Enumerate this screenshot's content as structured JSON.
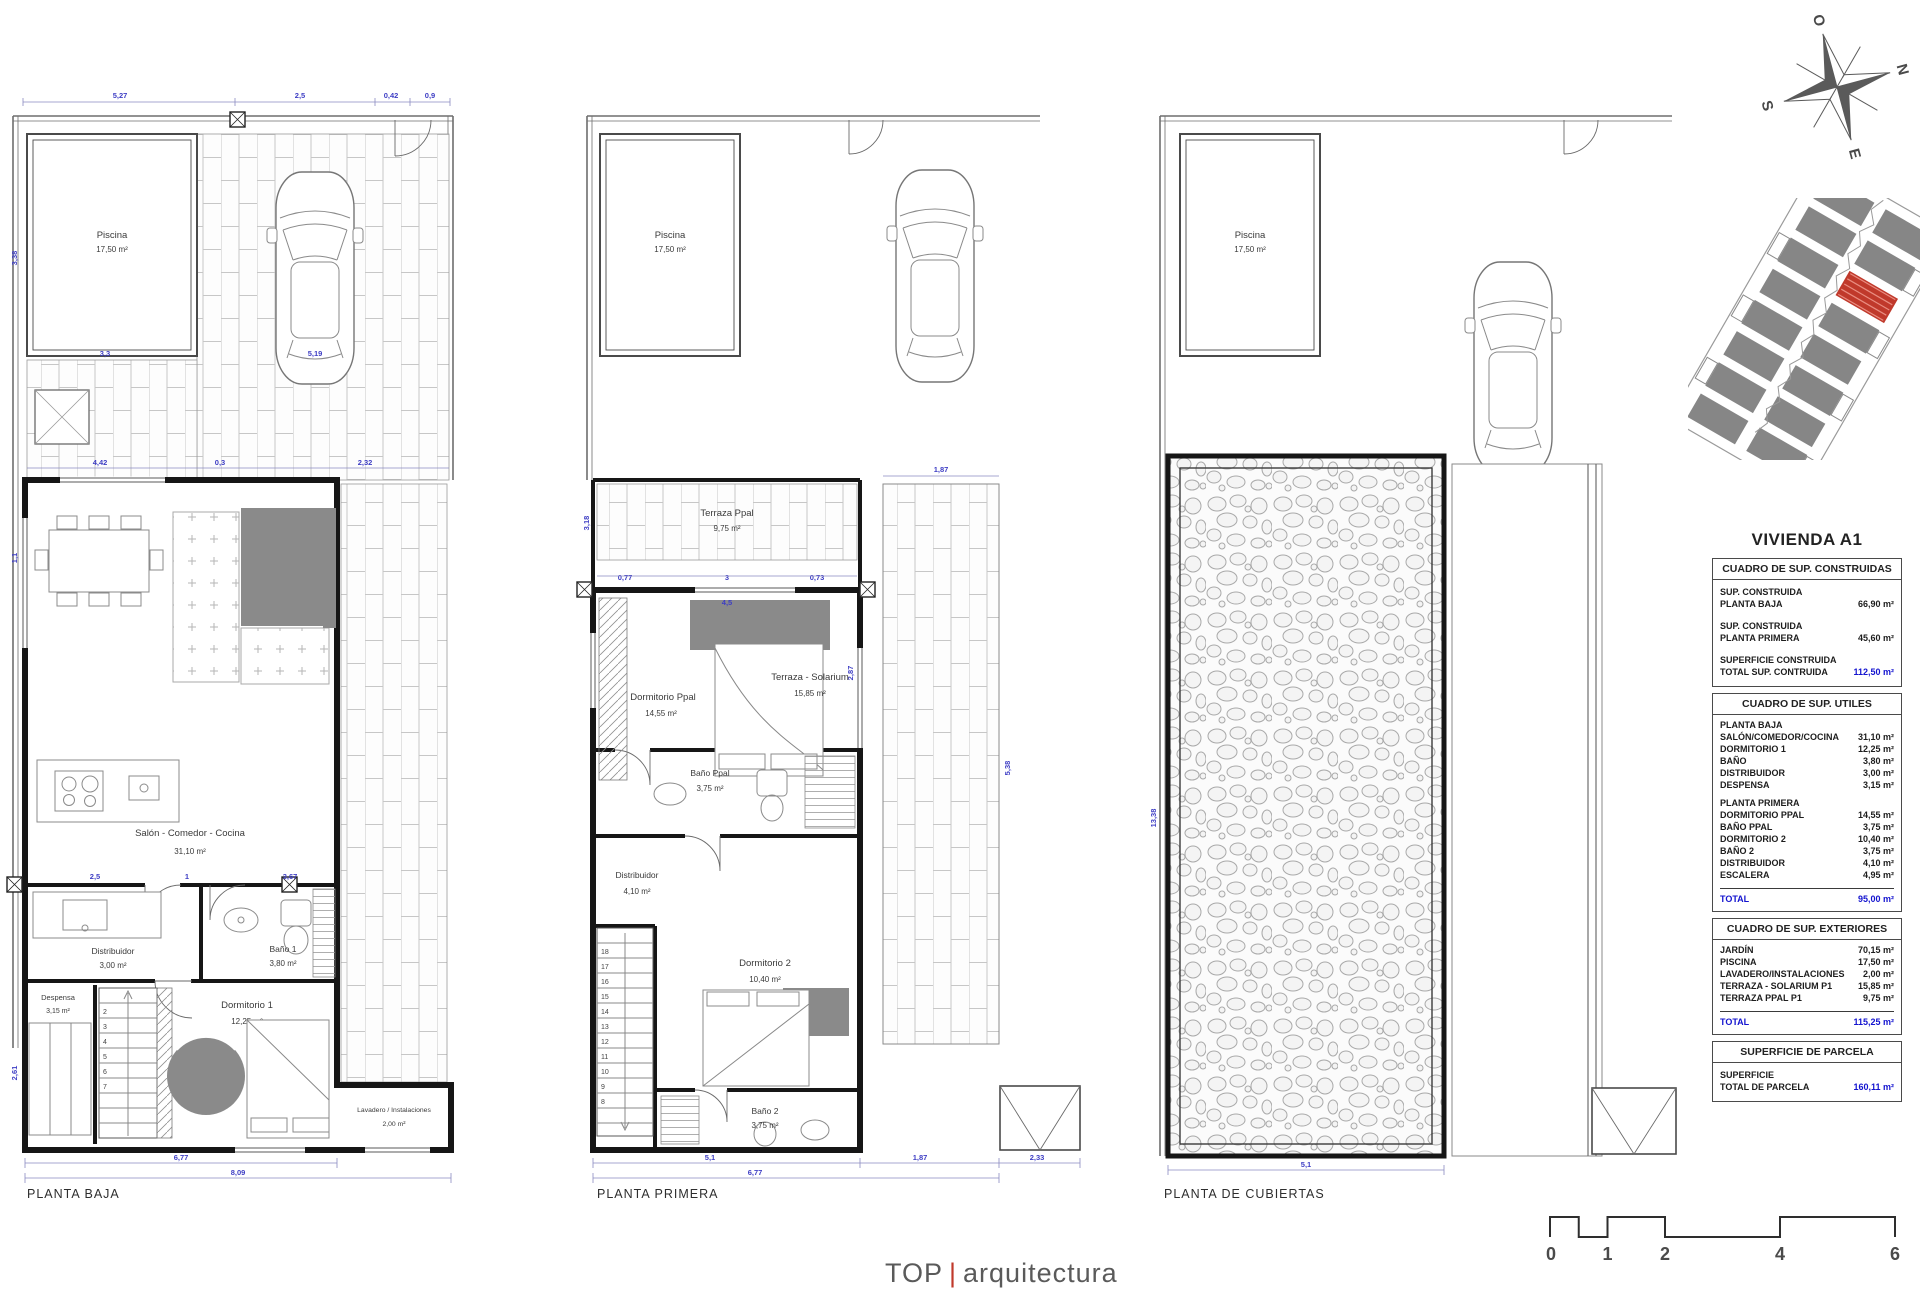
{
  "p1": {
    "title": "PLANTA BAJA",
    "pool_name": "Piscina",
    "pool_area": "17,50 m²",
    "salon_name": "Salón - Comedor - Cocina",
    "salon_area": "31,10 m²",
    "distrib_name": "Distribuidor",
    "distrib_area": "3,00 m²",
    "bano_name": "Baño 1",
    "bano_area": "3,80 m²",
    "despensa_name": "Despensa",
    "despensa_area": "3,15 m²",
    "dorm_name": "Dormitorio 1",
    "dorm_area": "12,25 m²",
    "lavadero_name": "Lavadero / Instalaciones",
    "lavadero_area": "2,00 m²",
    "dims": {
      "t1": "5,27",
      "t2": "2,5",
      "t3": "0,42",
      "t4": "0,9",
      "m1": "3,3",
      "m2": "5,19",
      "m3": "4,42",
      "m4": "0,3",
      "m5": "2,32",
      "r1": "2,5",
      "r2": "1",
      "r3": "3,67",
      "b1": "6,77",
      "b2": "8,09",
      "v1": "3,38",
      "v2": "1,1",
      "v3": "2,61"
    },
    "stairs": [
      "2",
      "3",
      "4",
      "5",
      "6",
      "7"
    ]
  },
  "p2": {
    "title": "PLANTA PRIMERA",
    "pool_name": "Piscina",
    "pool_area": "17,50 m²",
    "terraza_name": "Terraza Ppal",
    "terraza_area": "9,75 m²",
    "dormppal_name": "Dormitorio Ppal",
    "dormppal_area": "14,55 m²",
    "banoppal_name": "Baño Ppal",
    "banoppal_area": "3,75 m²",
    "distrib_name": "Distribuidor",
    "distrib_area": "4,10 m²",
    "dorm2_name": "Dormitorio 2",
    "dorm2_area": "10,40 m²",
    "bano2_name": "Baño 2",
    "bano2_area": "3,75 m²",
    "solarium_name": "Terraza - Solarium",
    "solarium_area": "15,85 m²",
    "dims": {
      "tp1": "0,77",
      "tp2": "3",
      "tp3": "0,73",
      "w": "4,5",
      "h": "2,87",
      "e1": "3,18",
      "s1": "1,87",
      "v1": "5,38",
      "b1": "5,1",
      "b2": "6,77",
      "b3": "1,87",
      "b4": "2,33"
    },
    "stairs": [
      "18",
      "17",
      "16",
      "15",
      "14",
      "13",
      "12",
      "11",
      "10",
      "9",
      "8"
    ]
  },
  "p3": {
    "title": "PLANTA DE CUBIERTAS",
    "pool_name": "Piscina",
    "pool_area": "17,50 m²",
    "dims": {
      "b1": "5,1",
      "v1": "13,38"
    }
  },
  "compass": {
    "n": "N",
    "s": "S",
    "e": "E",
    "o": "O"
  },
  "sidebar": {
    "title": "VIVIENDA A1",
    "t1": {
      "header": "CUADRO DE SUP. CONSTRUIDAS",
      "r1a": "SUP. CONSTRUIDA",
      "r1b": "PLANTA BAJA",
      "r1v": "66,90 m²",
      "r2a": "SUP. CONSTRUIDA",
      "r2b": "PLANTA PRIMERA",
      "r2v": "45,60 m²",
      "r3a": "SUPERFICIE CONSTRUIDA",
      "r3b": "TOTAL SUP. CONTRUIDA",
      "r3v": "112,50 m²"
    },
    "t2": {
      "header": "CUADRO DE SUP. UTILES",
      "s1": "PLANTA BAJA",
      "rows1": [
        [
          "SALÓN/COMEDOR/COCINA",
          "31,10 m²"
        ],
        [
          "DORMITORIO 1",
          "12,25 m²"
        ],
        [
          "BAÑO",
          "3,80 m²"
        ],
        [
          "DISTRIBUIDOR",
          "3,00 m²"
        ],
        [
          "DESPENSA",
          "3,15 m²"
        ]
      ],
      "s2": "PLANTA PRIMERA",
      "rows2": [
        [
          "DORMITORIO PPAL",
          "14,55 m²"
        ],
        [
          "BAÑO PPAL",
          "3,75 m²"
        ],
        [
          "DORMITORIO 2",
          "10,40 m²"
        ],
        [
          "BAÑO 2",
          "3,75 m²"
        ],
        [
          "DISTRIBUIDOR",
          "4,10 m²"
        ],
        [
          "ESCALERA",
          "4,95 m²"
        ]
      ],
      "total_label": "TOTAL",
      "total_value": "95,00 m²"
    },
    "t3": {
      "header": "CUADRO DE SUP. EXTERIORES",
      "rows": [
        [
          "JARDÍN",
          "70,15 m²"
        ],
        [
          "PISCINA",
          "17,50 m²"
        ],
        [
          "LAVADERO/INSTALACIONES",
          "2,00 m²"
        ],
        [
          "TERRAZA - SOLARIUM P1",
          "15,85 m²"
        ],
        [
          "TERRAZA PPAL P1",
          "9,75 m²"
        ]
      ],
      "total_label": "TOTAL",
      "total_value": "115,25 m²"
    },
    "t4": {
      "header": "SUPERFICIE DE PARCELA",
      "r1a": "SUPERFICIE",
      "r1b": "TOTAL DE PARCELA",
      "r1v": "160,11 m²"
    }
  },
  "scalebar": {
    "labels": [
      "0",
      "1",
      "2",
      "4",
      "6"
    ]
  },
  "footer": {
    "brand": "TOP",
    "sep": "|",
    "name": "arquitectura"
  }
}
